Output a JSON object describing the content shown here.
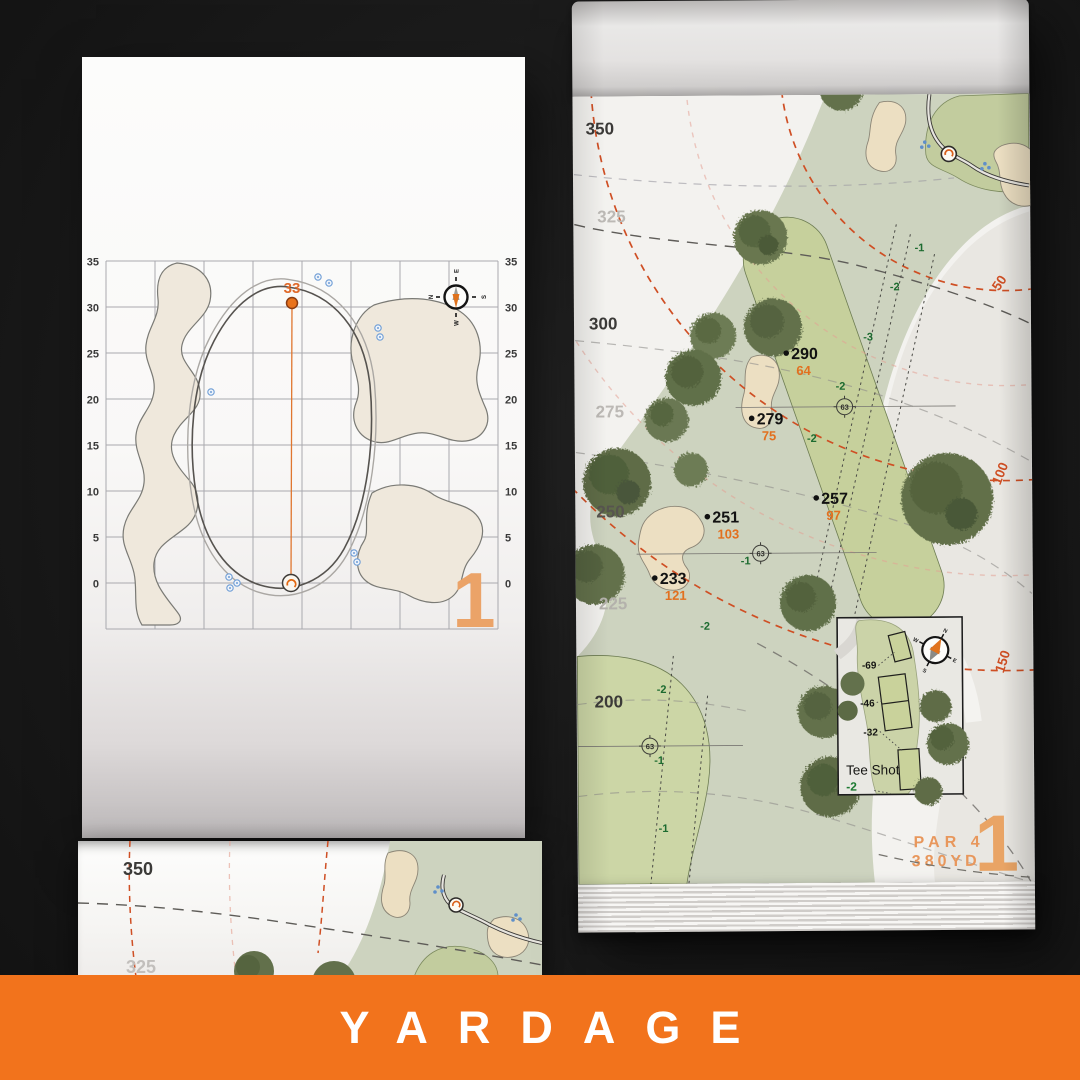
{
  "banner": {
    "label": "YARDAGE"
  },
  "left_page": {
    "hole_number": "1",
    "front_distance": "33",
    "axis_ticks_left": [
      "35",
      "30",
      "25",
      "20",
      "15",
      "10",
      "5",
      "0"
    ],
    "axis_ticks_right": [
      "35",
      "30",
      "25",
      "20",
      "15",
      "10",
      "5",
      "0"
    ],
    "compass": {
      "n": "N",
      "e": "E",
      "s": "S",
      "w": "W"
    }
  },
  "right_page": {
    "hole_number": "1",
    "par_label": "PAR 4",
    "yardage_label": "380YD",
    "distance_scale": [
      {
        "label": "350",
        "emphasis": "dark"
      },
      {
        "label": "325",
        "emphasis": "light"
      },
      {
        "label": "300",
        "emphasis": "dark"
      },
      {
        "label": "275",
        "emphasis": "light"
      },
      {
        "label": "250",
        "emphasis": "dark"
      },
      {
        "label": "225",
        "emphasis": "light"
      },
      {
        "label": "200",
        "emphasis": "dark"
      }
    ],
    "arc_labels": [
      "50",
      "100",
      "150"
    ],
    "points": [
      {
        "distance": "290",
        "to_front": "64"
      },
      {
        "distance": "279",
        "to_front": "75"
      },
      {
        "distance": "257",
        "to_front": "97"
      },
      {
        "distance": "251",
        "to_front": "103"
      },
      {
        "distance": "233",
        "to_front": "121"
      }
    ],
    "sprinkler_markers": [
      "63",
      "63",
      "63"
    ],
    "elevations": [
      "-1",
      "-2",
      "-3",
      "-2",
      "-2",
      "-1",
      "-2",
      "-2",
      "-1",
      "-1"
    ],
    "tee_inset": {
      "title": "Tee Shot",
      "elevation": "-2",
      "tee_yardages": [
        "-69",
        "-46",
        "-32"
      ]
    },
    "compass": {
      "n": "N",
      "e": "E",
      "s": "S",
      "w": "W"
    }
  },
  "next_page": {
    "scale_labels": [
      "350",
      "325"
    ]
  },
  "colors": {
    "accent_orange": "#f2731c",
    "arc_orange": "#cf4f24",
    "number_orange": "#e2701f",
    "big_number": "#e9a465",
    "elevation_green": "#1d6b30"
  }
}
